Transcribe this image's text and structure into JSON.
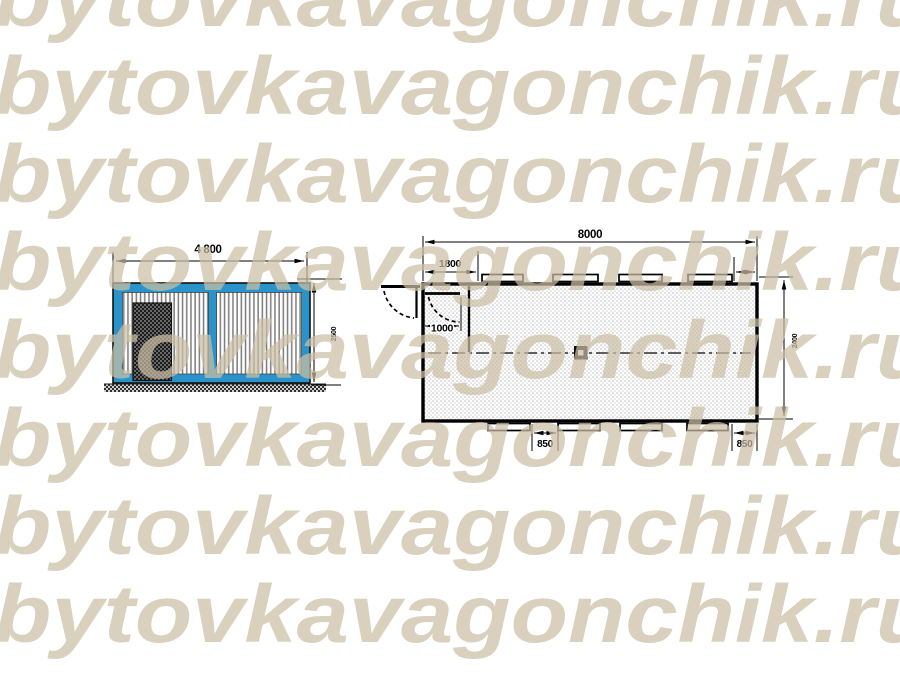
{
  "watermark": {
    "text": "bytovkavagonchik.ru",
    "color": "#cabfa3",
    "rows": 8
  },
  "elevation_view": {
    "title": "cabin front elevation",
    "dim_width": "4 800",
    "dim_height": "2500",
    "frame_color": "#2a93cc"
  },
  "plan_view": {
    "title": "cabin floor plan",
    "dim_length": "8000",
    "dim_vestibule_width": "1800",
    "dim_door_width": "1000",
    "dim_window_gap": "850",
    "dim_end_gap": "850",
    "dim_depth": "2400"
  },
  "colors": {
    "line": "#000000",
    "background": "#ffffff",
    "frame_blue": "#2a93cc"
  }
}
